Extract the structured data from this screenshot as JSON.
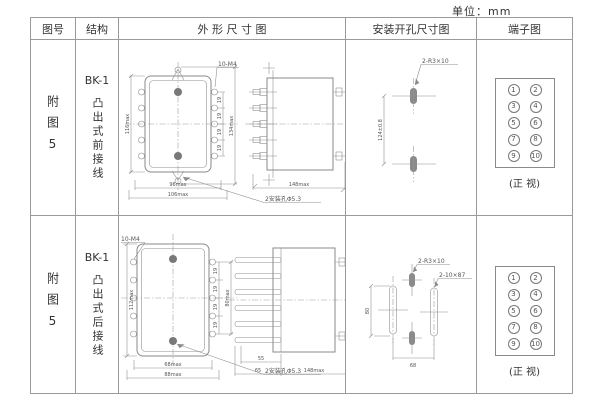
{
  "unit_label": "单位：mm",
  "headers": {
    "fig_no": "图号",
    "structure": "结构",
    "outline": "外 形 尺 寸 图",
    "mounting": "安装开孔尺寸图",
    "terminal": "端子图"
  },
  "rows": [
    {
      "fig_no": "附图5",
      "model": "BK-1",
      "wiring": "凸出式前接线",
      "front": {
        "height_dim": "116max",
        "height_outer_dim": "134max",
        "thread_label": "10-M4",
        "pitch_dim": "19",
        "width_dim": "96max",
        "width_outer_dim": "106max",
        "hole_note": "2安装孔Φ5.3"
      },
      "side": {
        "depth_dim": "148max"
      },
      "mounting": {
        "slot_label": "2-R3×10",
        "vertical_dim": "124±0.8"
      },
      "terminals": {
        "left": [
          "1",
          "3",
          "5",
          "7",
          "9"
        ],
        "right": [
          "2",
          "4",
          "6",
          "8",
          "10"
        ],
        "caption": "(正 视)"
      }
    },
    {
      "fig_no": "附图5",
      "model": "BK-1",
      "wiring": "凸出式后接线",
      "front": {
        "thread_label": "10-M4",
        "height_dim": "112max",
        "pitch_dim": "19",
        "height_outer_dim": "80max",
        "width_dim": "68max",
        "width_outer_dim": "88max",
        "hole_note": "2安装孔Φ5.3"
      },
      "side": {
        "pin_dim": "55",
        "pin_outer_dim": "65",
        "depth_dim": "148max"
      },
      "mounting": {
        "slot_label_small": "2-R3×10",
        "slot_label_large": "2-10×87",
        "vertical_dim": "80",
        "horizontal_dim": "68"
      },
      "terminals": {
        "left": [
          "1",
          "3",
          "5",
          "7",
          "9"
        ],
        "right": [
          "2",
          "4",
          "6",
          "8",
          "10"
        ],
        "caption": "(正 视)"
      }
    }
  ],
  "colors": {
    "line": "#8a8a8a",
    "text": "#555555",
    "table_border": "#9a9a9a"
  }
}
